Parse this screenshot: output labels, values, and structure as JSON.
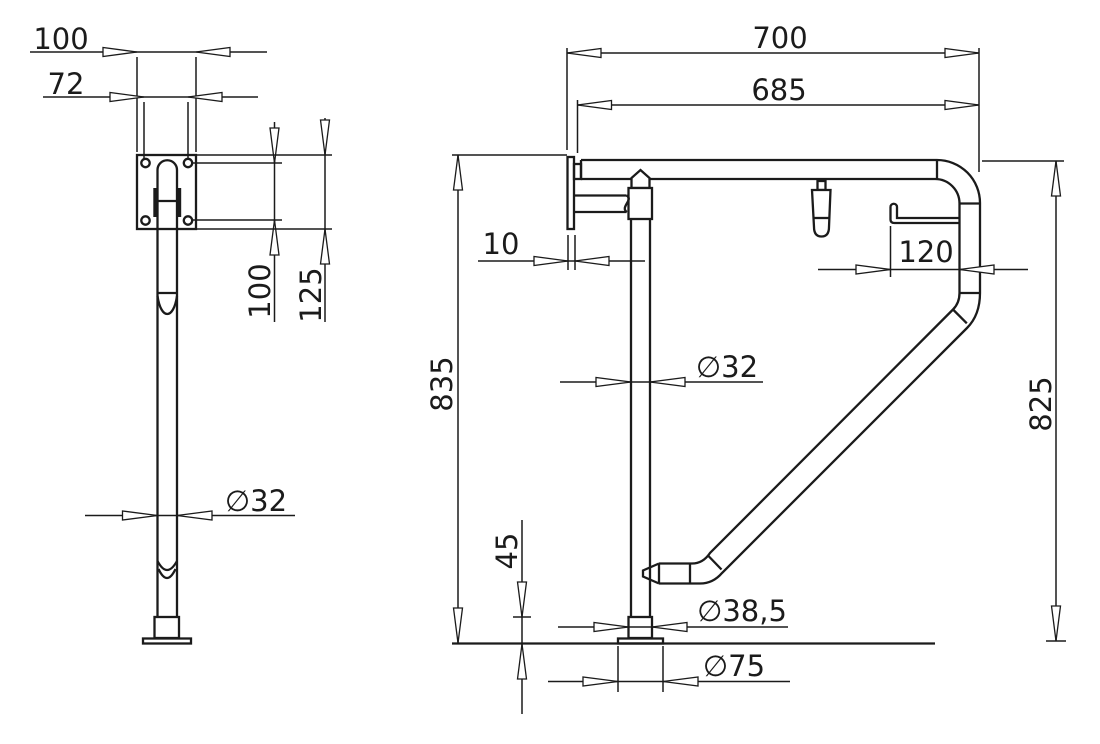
{
  "drawing": {
    "kind": "technical-dimension-drawing",
    "subject": "fold-up support grab rail, two orthographic views",
    "line_color": "#1b1b1b",
    "background": "#ffffff",
    "front": {
      "plate_width": "100",
      "hole_spacing_h": "72",
      "hole_spacing_v": "100",
      "plate_height": "125",
      "tube_diameter": "∅32"
    },
    "side": {
      "depth_overall": "700",
      "rail_depth": "685",
      "wall_plate_thickness": "10",
      "roll_holder_offset": "120",
      "tube_diameter": "∅32",
      "height_front": "835",
      "height_rear": "825",
      "base_collar_height": "45",
      "base_collar_diameter": "∅38,5",
      "base_plate_diameter": "∅75"
    }
  }
}
